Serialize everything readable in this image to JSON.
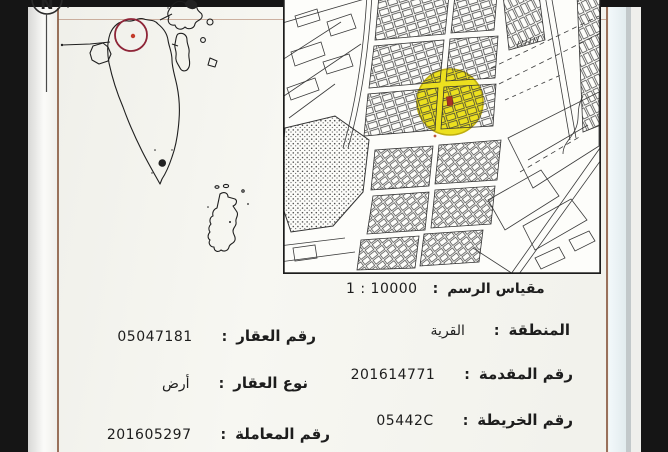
{
  "colon": ":",
  "north": {
    "letter": "N"
  },
  "scale": {
    "label": "مقياس الرسم",
    "value": "10000 : 1"
  },
  "fields_right": [
    {
      "label": "المنطقة",
      "value": "القرية"
    },
    {
      "label": "رقم المقدمة",
      "value": "201614771"
    },
    {
      "label": "رقم الخريطة",
      "value": "05442C"
    }
  ],
  "fields_left": [
    {
      "label": "رقم العقار",
      "value": "05047181"
    },
    {
      "label": "نوع العقار",
      "value": "أرض"
    },
    {
      "label": "رقم المعاملة",
      "value": "201605297"
    }
  ],
  "colors": {
    "highlight_yellow": "#ece01f",
    "marker_red": "#a83226",
    "overview_circle_red": "#8e2437",
    "frame_brown": "#8a5a42"
  }
}
